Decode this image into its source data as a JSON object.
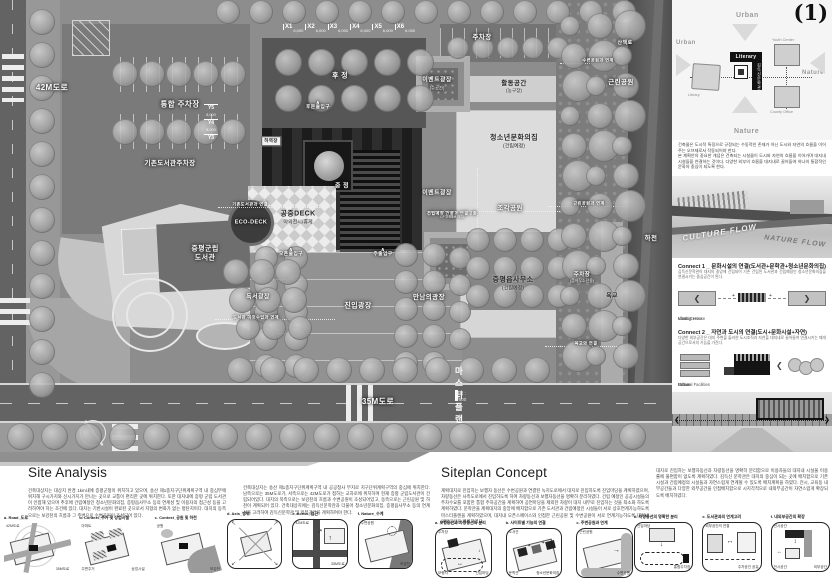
{
  "page_number": "(1)",
  "plan": {
    "masterplan": {
      "title": "마스터플랜",
      "scale": "축척 : 1/500"
    },
    "grid_x": {
      "labels": [
        "X1",
        "X2",
        "X3",
        "X4",
        "X5",
        "X6"
      ],
      "dim": "6,000"
    },
    "grid_y": {
      "labels": [
        "Y5",
        "Y4",
        "Y3"
      ],
      "dim": "8,000"
    },
    "labels": [
      {
        "t": "42M도로",
        "x": 52,
        "y": 88,
        "f": 8
      },
      {
        "t": "통합 주차장",
        "x": 180,
        "y": 104,
        "f": 7.5
      },
      {
        "t": "기존도서관주차장",
        "x": 170,
        "y": 164,
        "f": 6.5
      },
      {
        "t": "후 정",
        "x": 340,
        "y": 77,
        "f": 7
      },
      {
        "t": "후문출입구",
        "x": 318,
        "y": 106,
        "f": 4.8,
        "ch": true
      },
      {
        "t": "주차장",
        "x": 482,
        "y": 38,
        "f": 6.5
      },
      {
        "t": "이벤트광장",
        "s": "(수공간)",
        "x": 437,
        "y": 84,
        "f": 6
      },
      {
        "t": "활동공간",
        "s": "(농구장)",
        "x": 514,
        "y": 87,
        "f": 6.5,
        "d": true
      },
      {
        "t": "청소년문화의집",
        "s": "(건립예정)",
        "x": 514,
        "y": 142,
        "f": 7,
        "d": true
      },
      {
        "t": "중 정",
        "x": 342,
        "y": 187,
        "f": 6
      },
      {
        "t": "하역장",
        "x": 271,
        "y": 141,
        "f": 4.5,
        "c": true
      },
      {
        "t": "공중DECK",
        "s": "야외전시/휴게",
        "x": 298,
        "y": 218,
        "f": 7,
        "d": true
      },
      {
        "t": "ECO-DECK",
        "x": 251,
        "y": 223,
        "f": 5.5
      },
      {
        "t": "기존도서관과 연결",
        "x": 250,
        "y": 204,
        "f": 4.2
      },
      {
        "t": "증평군립\n도서관",
        "x": 205,
        "y": 254,
        "f": 7
      },
      {
        "t": "독서광장",
        "x": 258,
        "y": 298,
        "f": 6
      },
      {
        "t": "도서관 야외수업과 연계",
        "x": 256,
        "y": 317,
        "f": 4.2
      },
      {
        "t": "이벤트광장",
        "x": 437,
        "y": 194,
        "f": 6
      },
      {
        "t": "건립예정 건물과 연결 2층",
        "s": "(2F 연결통로 예정)",
        "x": 452,
        "y": 215,
        "f": 4.2
      },
      {
        "t": "조각공원",
        "x": 510,
        "y": 209,
        "f": 6.5
      },
      {
        "t": "오픈출입구",
        "x": 291,
        "y": 253,
        "f": 4.8,
        "ch": true
      },
      {
        "t": "주출입구",
        "x": 383,
        "y": 253,
        "f": 4.8,
        "ch": true
      },
      {
        "t": "진입광장",
        "x": 358,
        "y": 307,
        "f": 7
      },
      {
        "t": "만남의광장",
        "x": 429,
        "y": 298,
        "f": 6.5
      },
      {
        "t": "증평읍사무소",
        "s": "(건립예정)",
        "x": 513,
        "y": 284,
        "f": 7,
        "d": true
      },
      {
        "t": "주차장",
        "s": "(읍사무소전용)",
        "x": 582,
        "y": 278,
        "f": 5.5
      },
      {
        "t": "근린공원",
        "x": 621,
        "y": 83,
        "f": 6.5
      },
      {
        "t": "산책로",
        "x": 625,
        "y": 43,
        "f": 5
      },
      {
        "t": "수변공원과 연계",
        "x": 598,
        "y": 60,
        "f": 4.2
      },
      {
        "t": "근린공원과 연계",
        "x": 589,
        "y": 203,
        "f": 4.2
      },
      {
        "t": "하천",
        "x": 651,
        "y": 239,
        "f": 6.5
      },
      {
        "t": "육교",
        "x": 612,
        "y": 297,
        "f": 6,
        "d": true
      },
      {
        "t": "육교와 연결",
        "x": 586,
        "y": 343,
        "f": 4.2
      },
      {
        "t": "35M도로",
        "x": 378,
        "y": 402,
        "f": 8
      }
    ]
  },
  "sidebar": {
    "concept": {
      "urban_top": "Urban",
      "urban_left": "Urban",
      "nature_right": "Nature",
      "nature_bottom": "Nature",
      "literary": "Literary",
      "literary_kr": "김득신문학관",
      "library": "Library",
      "youth": "Youth Center",
      "county": "County Office"
    },
    "intro_1": "건축물은 도시적 특징으로 규정되는 수동적인 존재가 아닌 도시와 자연의 흐름을 이어주는 오브제로서 작동되어야 한다.",
    "intro_2": "본 계획안의 중요한 개념은 건축되는 시설물이 도시와 자연의 흐름을 이어가며 대지내 시설들을 연결하는 것이다. 다양한 외부의 흐름을 대지내로 끌어들여 하나의 통합적인 문화의 중심이 되도록 한다.",
    "flow_culture": "CULTURE FLOW",
    "flow_nature": "NATURE FLOW",
    "connect1": {
      "title": "Connect 1 _ 문화시설의 연결(도서관+문학관+청소년문화의집)",
      "desc": "김득신문학관이 대지의 중앙에 건립되어 기존 건립된 도서관과 건립예정인 청소년문화의집을 연결시키는 중심공간이 된다.",
      "items": [
        "Library",
        "Literary House",
        "Youth Center"
      ]
    },
    "connect2": {
      "title": "Connect 2 _ 자연과 도시의 연결(도시+문화시설+자연)",
      "desc": "다양한 외부공간은 대지 주변을 둘러싼 도시조직과 자연을 대지내로 끌어들여 연결시키는 매개공간으로서의 기능을 가진다.",
      "items": [
        "Urban",
        "Cultural Facilities",
        "Nature"
      ]
    }
  },
  "site_analysis": {
    "title": "Site Analysis",
    "para_1": "건축대상지는 대상지 반경 1km내에 증평군청이 위치하고 있으며, 송산 제1종지구단위계획구역 내 중심부에 위치해 구시가지와 신시가지가 만나는 곳으로 교통이 편리한 곳에 위치한다. 또한 대지내에 증평 군립 도서관이 인접해 있으며 추후에 건립예정인 청소년문화의집, 증평읍사무소 등의 연계성 및 이용자의 접근성 등을 고려하여야 하는 조건에 있다. 대지는 기반시설이 완료된 곳으로서 지형의 변화가 없는 평탄지이다. 대지의 동측으로는 보강천의 흐름과 그 주변으로 수변공원이 조성되어 있다.",
    "para_2": "건축대상지는 송산 제1종지구단위계획구역 내 공공청사 부지로 지구단위계획구역의 중심에 위치한다. 남측으로는 35M도로가, 서측으로는 42M도로가 접하는 교차로에 위치하며 현재 증평 군립도서관이 건립되어있다. 대지의 북측으로는 보강천의 흐름과 수변공원이 조성되어있고, 동측으로는 근린공원 및 하천이 계획되어 있다. 건축대상지에는 김득신문학관과 더불어 청소년문화의집, 증평읍사무소 등의 연계성을 고려하여 김득신문학관 및 외부공간을 계획하여야 한다.",
    "diagrams": [
      {
        "caption": "a. Road_도로",
        "labels": [
          "42M도로",
          "35M도로"
        ],
        "kind": "road",
        "frame": false
      },
      {
        "caption": "b. Context_주거 및 상업시설",
        "labels": [
          "아파트",
          "상업시설",
          "주변주거"
        ],
        "kind": "context",
        "frame": false
      },
      {
        "caption": "c. Context_공원 및 하천",
        "labels": [
          "공원",
          "보강천"
        ],
        "kind": "river",
        "frame": false
      },
      {
        "caption": "d. Axis_방위",
        "labels": [],
        "kind": "axis",
        "frame": true
      },
      {
        "caption": "e. Acess_접근",
        "labels": [
          "42M도로",
          "35M도로"
        ],
        "kind": "access",
        "frame": true
      },
      {
        "caption": "f. Nature_수계",
        "labels": [
          "수변공원",
          "보강천"
        ],
        "kind": "water",
        "frame": true
      }
    ]
  },
  "siteplan_concept": {
    "title": "Siteplan Concept",
    "para_1": "계획대지로 진입하는 보행자 동선은 수변공원과 연결된 녹지도로에서 대지로 진입하도록 진입마당을 계획하였으며, 차량동선은 사측도로에서 진입하도록 하여 차량동선과 보행자동선을 명확히 분리하였다. 건립 예정인 공공시설들의 주차수요를 포함한 통합 주차공간을 계획하여 공연마당을 제외한 차량이 대지 내부로 진입하는 것을 최소화 하도록 계획하였다. 문학관을 계획대지의 중앙에 배치함으로 기존 도서관과 건립예정인 시설들이 서로 상호연계가능하도록 마스터플랜을 계획하였으며, 대지내 오픈스페이스와 인접한 근린공원 및 수변공원이 서로 연계가능하도록 대지내 외부공간을 계획하였다.",
    "para_2": "대지로 진입하는 보행자동선과 차량동선을 명확히 분리함으로 이용자들의 대지내 시설물 이용률에 불편함이 없도록 계획하였다. 김득신 문학관은 대지의 중심이 되는 곳에 배치함으로 기존시설과 건립예정의 시설들과 자연스럽게 연계될 수 있도록 배치계획을 하였다. 전시, 교육동 내부공간들과 다양한 외부공간을 인접배치함으로 시지각적으로 내외부공간이 자연스럽게 확장되도록 배치하였다.",
    "diagrams": [
      {
        "caption": "a. 보행동선과 차량동선의 분리",
        "labels": [
          "주차장",
          "진입마당",
          "보행자"
        ],
        "kind": "flow",
        "frame": true
      },
      {
        "caption": "b. 사이트별 기능의 연결",
        "labels": [
          "도서관",
          "청소년문화의집",
          "문학관"
        ],
        "kind": "connect",
        "frame": true
      },
      {
        "caption": "c. 주변공원과 연계",
        "labels": [
          "근린공원",
          "수변공원"
        ],
        "kind": "park",
        "frame": true
      },
      {
        "caption": "d. 차량동선의 명확한 분리",
        "labels": [
          "진입마당",
          "통합주차장"
        ],
        "kind": "separate",
        "frame": true
      },
      {
        "caption": "e. 도서관과의 연계고려",
        "labels": [
          "외부공간의 연결",
          "주차공간 공유"
        ],
        "kind": "link",
        "frame": true
      },
      {
        "caption": "f. 내외부공간의 확장",
        "labels": [
          "전시공간",
          "외부공간",
          "전시공간"
        ],
        "kind": "expand",
        "frame": true
      }
    ]
  }
}
